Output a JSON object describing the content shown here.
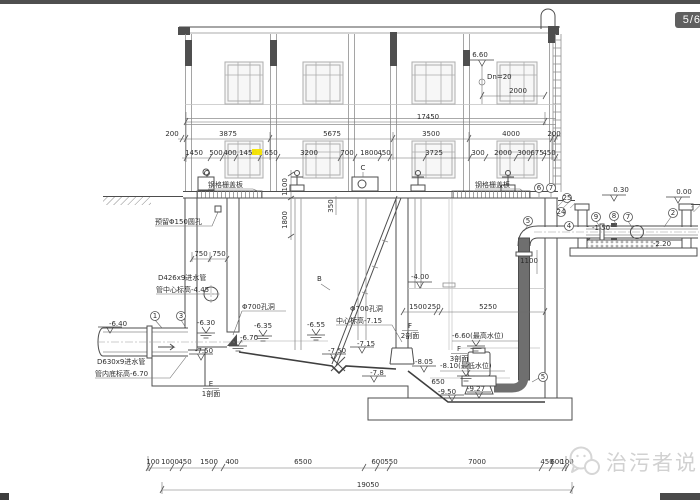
{
  "chrome": {
    "page_badge": "5/6",
    "watermark_text": "治污者说"
  },
  "t": {
    "d17450": "17450",
    "r2": [
      "200",
      "3875",
      "5675",
      "3500",
      "4000",
      "200"
    ],
    "r3": [
      "1450",
      "500",
      "400",
      "1450",
      "650",
      "3200",
      "700",
      "1800",
      "450",
      "3725",
      "300",
      "2000",
      "300",
      "675",
      "450"
    ],
    "bottom": [
      "100",
      "1000",
      "450",
      "1500",
      "400",
      "6500",
      "600",
      "550",
      "7000",
      "450",
      "600",
      "100"
    ],
    "d19050": "19050",
    "e660": "6.60",
    "dn20": "Dn=20",
    "d2000": "2000",
    "d750a": "750",
    "d750b": "750",
    "d1100": "1100",
    "d1800": "1800",
    "d350": "350",
    "d1100b": "1100",
    "d1500": "1500",
    "d250": "250",
    "d5250": "5250",
    "d650": "650",
    "e030": "0.30",
    "e000": "0.00",
    "em400": "-4.00",
    "em640": "-6.40",
    "em630": "-6.30",
    "em670": "-6.70",
    "em635": "-6.35",
    "em655": "-6.55",
    "em750": "-7.50",
    "em715": "-7.15",
    "em78": "-7.8",
    "em660max": "-6.60(最高水位)",
    "em810min": "-8.10(最低水位)",
    "em805": "-8.05",
    "em950": "-9.50",
    "em927": "-9.27",
    "em150": "-1.50",
    "em220": "-2.20",
    "grating": "钢格栅盖板",
    "hole150": "预留Φ150圆孔",
    "d426a": "D426x9进水管",
    "d426b": "管中心标高-4.45",
    "d630a": "D630x9进水管",
    "d630b": "管内底标高-6.70",
    "hole700": "Φ700孔洞",
    "center715": "中心标高-7.15",
    "lblB": "B",
    "lblC": "C",
    "secE": "E",
    "secF": "F",
    "sec1": "1剖面",
    "sec2": "2剖面",
    "sec3": "3剖面",
    "ref1": "1",
    "ref2": "2",
    "ref3": "3",
    "ref4": "4",
    "ref5": "5",
    "ref6": "6",
    "ref7": "7",
    "ref8": "8",
    "ref9": "9",
    "ref24": "24",
    "ref25": "25"
  }
}
